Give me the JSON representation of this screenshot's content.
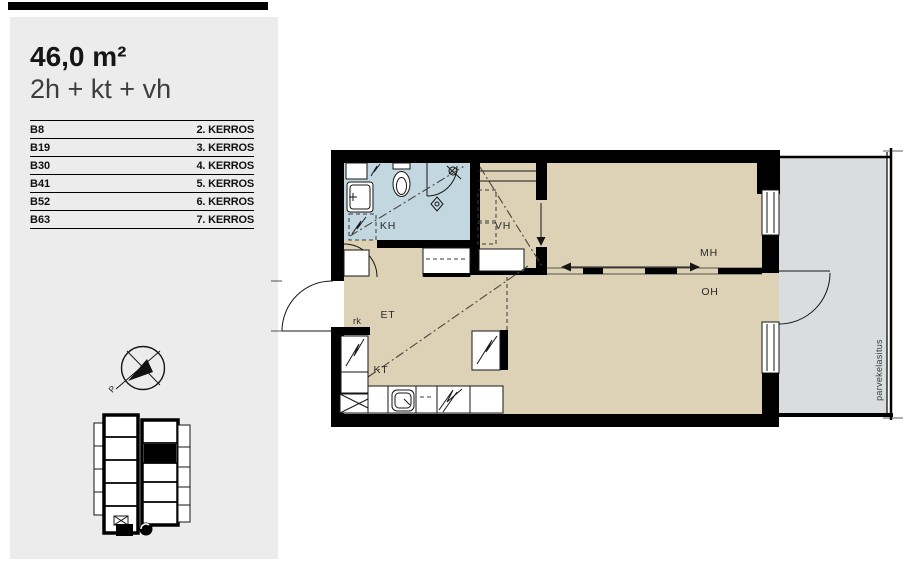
{
  "panel": {
    "area_label": "46,0 m²",
    "layout_label": "2h + kt + vh",
    "units": [
      {
        "id": "B8",
        "floor": "2. KERROS"
      },
      {
        "id": "B19",
        "floor": "3. KERROS"
      },
      {
        "id": "B30",
        "floor": "4. KERROS"
      },
      {
        "id": "B41",
        "floor": "5. KERROS"
      },
      {
        "id": "B52",
        "floor": "6. KERROS"
      },
      {
        "id": "B63",
        "floor": "7. KERROS"
      }
    ]
  },
  "plan": {
    "rooms": {
      "kh": "KH",
      "vh": "VH",
      "et": "ET",
      "kt": "KT",
      "mh": "MH",
      "oh": "OH"
    },
    "annotations": {
      "rk": "rk",
      "balcony_glazing": "parvekelasitus",
      "compass_north": "P"
    }
  },
  "colors": {
    "floor": "#ddd2b5",
    "bathroom_floor": "#c3d7e0",
    "balcony_floor": "#d9dde0",
    "panel_background": "#ececec",
    "wall": "#000000"
  }
}
